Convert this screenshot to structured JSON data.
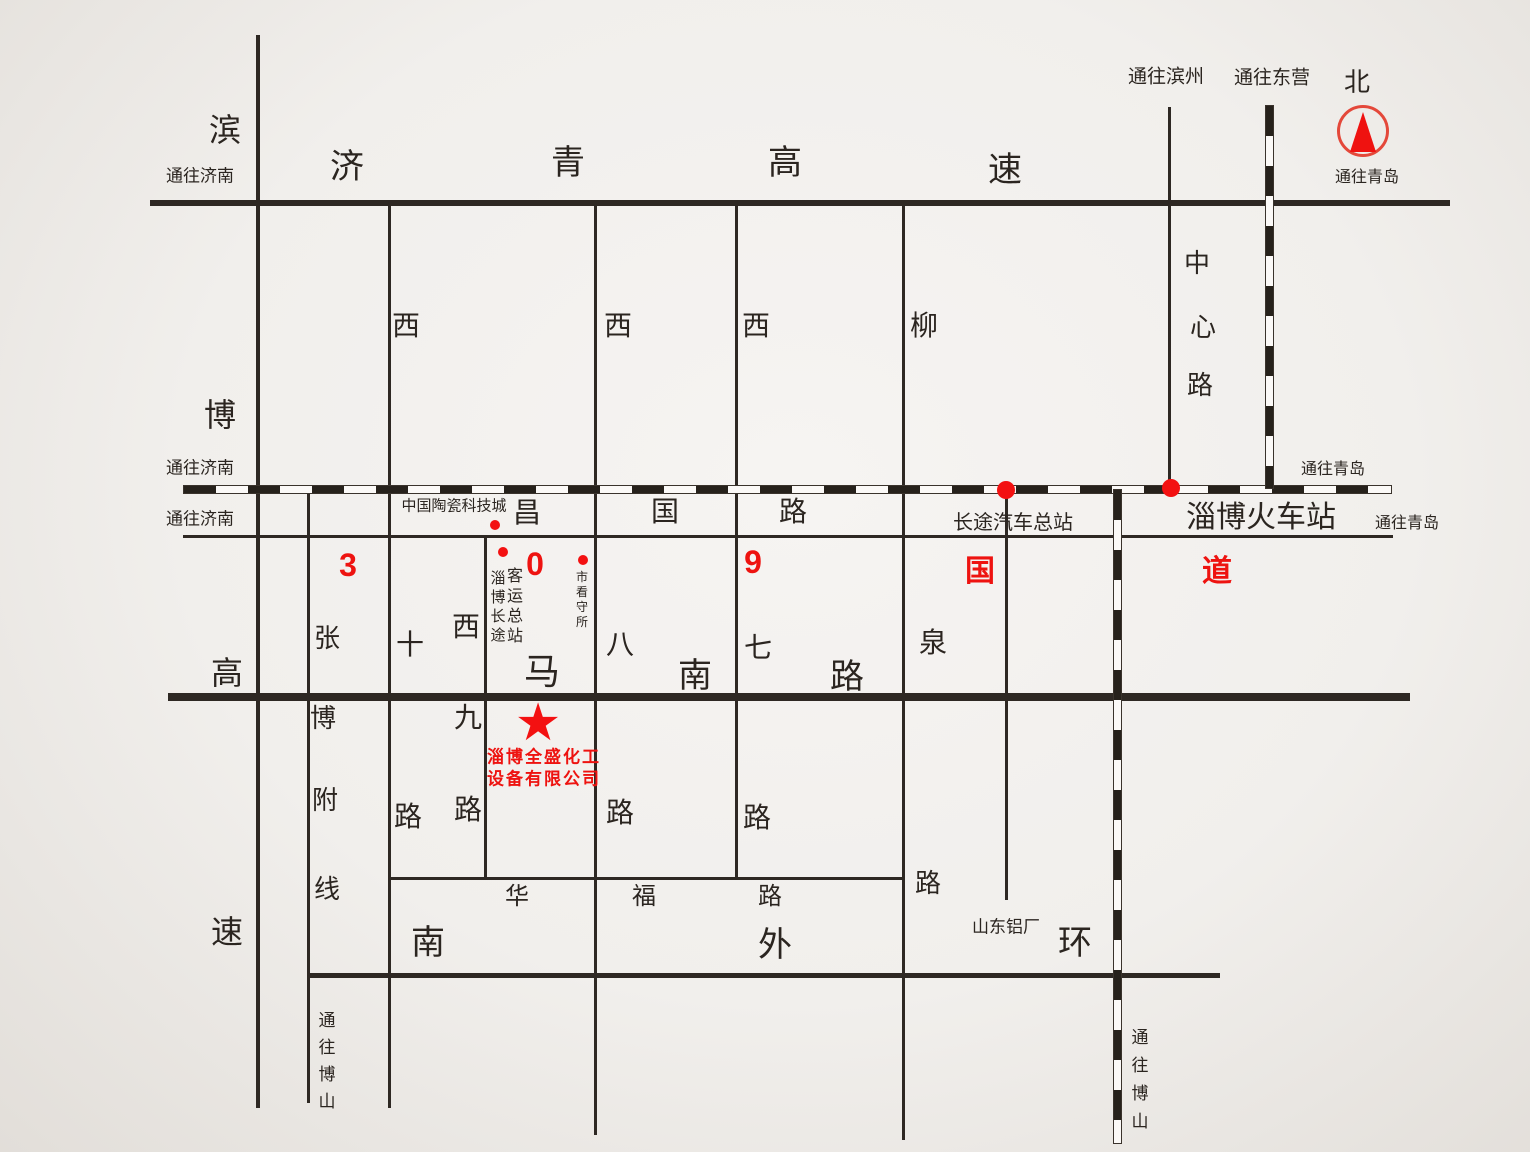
{
  "canvas": {
    "w": 1530,
    "h": 1152,
    "ink": "#2e2823",
    "red": "#ee1310"
  },
  "compass": {
    "name": "north-compass",
    "x": 1363,
    "y": 131,
    "r": 26
  },
  "lines": [
    {
      "n": "jiqing-expressway",
      "x1": 150,
      "y1": 203,
      "x2": 1450,
      "y2": 203,
      "w": 6
    },
    {
      "n": "changguo-road",
      "x1": 183,
      "y1": 536,
      "x2": 1393,
      "y2": 536,
      "w": 3
    },
    {
      "n": "nanma-road",
      "x1": 168,
      "y1": 697,
      "x2": 1410,
      "y2": 697,
      "w": 8
    },
    {
      "n": "huafu-road",
      "x1": 389,
      "y1": 878,
      "x2": 903,
      "y2": 878,
      "w": 3
    },
    {
      "n": "nanwaihuan-road",
      "x1": 310,
      "y1": 975,
      "x2": 1220,
      "y2": 975,
      "w": 5
    },
    {
      "n": "binbo-expressway",
      "x1": 258,
      "y1": 35,
      "x2": 258,
      "y2": 1108,
      "w": 4
    },
    {
      "n": "zhangbo-branch-line",
      "x1": 308,
      "y1": 488,
      "x2": 308,
      "y2": 1103,
      "w": 3
    },
    {
      "n": "xishi-road",
      "x1": 389,
      "y1": 203,
      "x2": 389,
      "y2": 1108,
      "w": 3
    },
    {
      "n": "xijiu-road",
      "x1": 485,
      "y1": 536,
      "x2": 485,
      "y2": 878,
      "w": 3
    },
    {
      "n": "xiba-road",
      "x1": 595,
      "y1": 203,
      "x2": 595,
      "y2": 1135,
      "w": 3
    },
    {
      "n": "xiqi-road",
      "x1": 736,
      "y1": 203,
      "x2": 736,
      "y2": 878,
      "w": 3
    },
    {
      "n": "liuquan-road",
      "x1": 903,
      "y1": 203,
      "x2": 903,
      "y2": 1140,
      "w": 3
    },
    {
      "n": "station-access-road",
      "x1": 1006,
      "y1": 490,
      "x2": 1006,
      "y2": 900,
      "w": 3
    },
    {
      "n": "zhongxin-road",
      "x1": 1169,
      "y1": 107,
      "x2": 1169,
      "y2": 489,
      "w": 3
    },
    {
      "n": "railway-main",
      "x1": 183,
      "y1": 489,
      "x2": 1392,
      "y2": 489,
      "w": 9,
      "rail": 1
    },
    {
      "n": "railway-north-branch",
      "x1": 1269,
      "y1": 105,
      "x2": 1269,
      "y2": 489,
      "w": 9,
      "rail": 1
    },
    {
      "n": "railway-south-branch",
      "x1": 1117,
      "y1": 489,
      "x2": 1117,
      "y2": 1144,
      "w": 9,
      "rail": 1
    }
  ],
  "labels": [
    {
      "n": "dest-jinan-expressway",
      "t": "通往济南",
      "x": 200,
      "y": 176,
      "s": 17
    },
    {
      "n": "dest-jinan-railway",
      "t": "通往济南",
      "x": 200,
      "y": 468,
      "s": 17
    },
    {
      "n": "dest-jinan-changguo",
      "t": "通往济南",
      "x": 200,
      "y": 519,
      "s": 17
    },
    {
      "n": "dest-binzhou",
      "t": "通往滨州",
      "x": 1166,
      "y": 77,
      "s": 19
    },
    {
      "n": "dest-dongying",
      "t": "通往东营",
      "x": 1272,
      "y": 78,
      "s": 19
    },
    {
      "n": "north-label",
      "t": "北",
      "x": 1357,
      "y": 82,
      "s": 26
    },
    {
      "n": "dest-qingdao-compass",
      "t": "通往青岛",
      "x": 1367,
      "y": 178,
      "s": 16
    },
    {
      "n": "dest-qingdao-railway",
      "t": "通往青岛",
      "x": 1333,
      "y": 470,
      "s": 16
    },
    {
      "n": "dest-qingdao-changguo",
      "t": "通往青岛",
      "x": 1407,
      "y": 524,
      "s": 16
    },
    {
      "n": "dest-boshan-west",
      "t": "通往博山",
      "x": 327,
      "y": 1020,
      "s": 17,
      "d": "v",
      "st": 27
    },
    {
      "n": "dest-boshan-railway",
      "t": "通往博山",
      "x": 1140,
      "y": 1038,
      "s": 17,
      "d": "v",
      "st": 28
    },
    {
      "n": "jiqing-char-ji",
      "t": "济",
      "x": 347,
      "y": 167,
      "s": 34
    },
    {
      "n": "jiqing-char-qing",
      "t": "青",
      "x": 568,
      "y": 163,
      "s": 34
    },
    {
      "n": "jiqing-char-gao",
      "t": "高",
      "x": 785,
      "y": 163,
      "s": 34
    },
    {
      "n": "jiqing-char-su",
      "t": "速",
      "x": 1005,
      "y": 170,
      "s": 34
    },
    {
      "n": "binbo-char-bin",
      "t": "滨",
      "x": 225,
      "y": 130,
      "s": 32
    },
    {
      "n": "binbo-char-bo",
      "t": "博",
      "x": 220,
      "y": 415,
      "s": 32
    },
    {
      "n": "binbo-char-gao",
      "t": "高",
      "x": 227,
      "y": 673,
      "s": 32
    },
    {
      "n": "binbo-char-su",
      "t": "速",
      "x": 227,
      "y": 932,
      "s": 32
    },
    {
      "n": "changguo-char-chang",
      "t": "昌",
      "x": 527,
      "y": 513,
      "s": 28
    },
    {
      "n": "changguo-char-guo",
      "t": "国",
      "x": 665,
      "y": 512,
      "s": 28
    },
    {
      "n": "changguo-char-lu",
      "t": "路",
      "x": 793,
      "y": 512,
      "s": 28
    },
    {
      "n": "route309-char-3",
      "t": "3",
      "x": 348,
      "y": 565,
      "s": 32,
      "c": "red"
    },
    {
      "n": "route309-char-0",
      "t": "0",
      "x": 535,
      "y": 564,
      "s": 32,
      "c": "red"
    },
    {
      "n": "route309-char-9",
      "t": "9",
      "x": 753,
      "y": 562,
      "s": 32,
      "c": "red"
    },
    {
      "n": "route309-char-guo",
      "t": "国",
      "x": 980,
      "y": 572,
      "s": 30,
      "c": "red"
    },
    {
      "n": "route309-char-dao",
      "t": "道",
      "x": 1217,
      "y": 572,
      "s": 30,
      "c": "red"
    },
    {
      "n": "poi-ceramic-city",
      "t": "中国陶瓷科技城",
      "x": 454,
      "y": 506,
      "s": 15
    },
    {
      "n": "poi-bus-terminal-col1",
      "t": "淄博长途",
      "x": 498,
      "y": 578,
      "s": 15,
      "d": "v",
      "st": 19
    },
    {
      "n": "poi-bus-terminal-col2",
      "t": "客运总站",
      "x": 515,
      "y": 577,
      "s": 16,
      "d": "v",
      "st": 20
    },
    {
      "n": "poi-detention-house",
      "t": "市看守所",
      "x": 582,
      "y": 577,
      "s": 12,
      "d": "v",
      "st": 15
    },
    {
      "n": "poi-coach-station",
      "t": "长途汽车总站",
      "x": 1013,
      "y": 523,
      "s": 20
    },
    {
      "n": "poi-railway-station",
      "t": "淄博火车站",
      "x": 1261,
      "y": 518,
      "s": 30
    },
    {
      "n": "poi-aluminum-plant",
      "t": "山东铝厂",
      "x": 1006,
      "y": 927,
      "s": 17
    },
    {
      "n": "company-name-line1",
      "t": "淄博全盛化工",
      "x": 544,
      "y": 757,
      "s": 17,
      "c": "red",
      "ls": 2
    },
    {
      "n": "company-name-line2",
      "t": "设备有限公司",
      "x": 544,
      "y": 779,
      "s": 17,
      "c": "red",
      "ls": 2
    },
    {
      "n": "zhongxin-char-zhong",
      "t": "中",
      "x": 1197,
      "y": 263,
      "s": 26
    },
    {
      "n": "zhongxin-char-xin",
      "t": "心",
      "x": 1203,
      "y": 327,
      "s": 26
    },
    {
      "n": "zhongxin-char-lu",
      "t": "路",
      "x": 1200,
      "y": 385,
      "s": 26
    },
    {
      "n": "xishi-char-xi",
      "t": "西",
      "x": 406,
      "y": 326,
      "s": 28
    },
    {
      "n": "xishi-char-shi",
      "t": "十",
      "x": 410,
      "y": 645,
      "s": 28
    },
    {
      "n": "xishi-char-lu",
      "t": "路",
      "x": 408,
      "y": 817,
      "s": 28
    },
    {
      "n": "xijiu-char-xi",
      "t": "西",
      "x": 466,
      "y": 627,
      "s": 28
    },
    {
      "n": "xijiu-char-jiu",
      "t": "九",
      "x": 468,
      "y": 718,
      "s": 28
    },
    {
      "n": "xijiu-char-lu",
      "t": "路",
      "x": 468,
      "y": 810,
      "s": 28
    },
    {
      "n": "xiba-char-xi",
      "t": "西",
      "x": 618,
      "y": 326,
      "s": 28
    },
    {
      "n": "xiba-char-ba",
      "t": "八",
      "x": 620,
      "y": 645,
      "s": 28
    },
    {
      "n": "xiba-char-lu",
      "t": "路",
      "x": 620,
      "y": 813,
      "s": 28
    },
    {
      "n": "xiqi-char-xi",
      "t": "西",
      "x": 756,
      "y": 326,
      "s": 28
    },
    {
      "n": "xiqi-char-qi",
      "t": "七",
      "x": 758,
      "y": 648,
      "s": 28
    },
    {
      "n": "xiqi-char-lu",
      "t": "路",
      "x": 757,
      "y": 818,
      "s": 28
    },
    {
      "n": "liuquan-char-liu",
      "t": "柳",
      "x": 924,
      "y": 326,
      "s": 28
    },
    {
      "n": "liuquan-char-quan",
      "t": "泉",
      "x": 933,
      "y": 643,
      "s": 28
    },
    {
      "n": "liuquan-char-lu",
      "t": "路",
      "x": 928,
      "y": 883,
      "s": 26
    },
    {
      "n": "zhangbo-char-zhang",
      "t": "张",
      "x": 327,
      "y": 638,
      "s": 26
    },
    {
      "n": "zhangbo-char-bo",
      "t": "博",
      "x": 323,
      "y": 718,
      "s": 26
    },
    {
      "n": "zhangbo-char-fu",
      "t": "附",
      "x": 325,
      "y": 800,
      "s": 26
    },
    {
      "n": "zhangbo-char-xian",
      "t": "线",
      "x": 327,
      "y": 889,
      "s": 26
    },
    {
      "n": "nanma-char-ma",
      "t": "马",
      "x": 542,
      "y": 672,
      "s": 36
    },
    {
      "n": "nanma-char-nan",
      "t": "南",
      "x": 695,
      "y": 676,
      "s": 34
    },
    {
      "n": "nanma-char-lu",
      "t": "路",
      "x": 847,
      "y": 677,
      "s": 34
    },
    {
      "n": "huafu-char-hua",
      "t": "华",
      "x": 517,
      "y": 897,
      "s": 24
    },
    {
      "n": "huafu-char-fu",
      "t": "福",
      "x": 644,
      "y": 897,
      "s": 24
    },
    {
      "n": "huafu-char-lu",
      "t": "路",
      "x": 770,
      "y": 897,
      "s": 24
    },
    {
      "n": "nanwaihuan-char-nan",
      "t": "南",
      "x": 428,
      "y": 943,
      "s": 34
    },
    {
      "n": "nanwaihuan-char-wai",
      "t": "外",
      "x": 775,
      "y": 945,
      "s": 34
    },
    {
      "n": "nanwaihuan-char-huan",
      "t": "环",
      "x": 1075,
      "y": 943,
      "s": 34
    }
  ],
  "dots": [
    {
      "n": "ceramic-city-dot",
      "x": 495,
      "y": 525,
      "r": 5
    },
    {
      "n": "bus-terminal-dot",
      "x": 503,
      "y": 552,
      "r": 5
    },
    {
      "n": "detention-house-dot",
      "x": 583,
      "y": 560,
      "r": 5
    },
    {
      "n": "coach-station-dot",
      "x": 1006,
      "y": 490,
      "r": 9
    },
    {
      "n": "railway-station-dot",
      "x": 1171,
      "y": 488,
      "r": 9
    }
  ],
  "star": {
    "n": "company-location-star",
    "glyph": "★",
    "x": 538,
    "y": 723,
    "s": 52
  }
}
